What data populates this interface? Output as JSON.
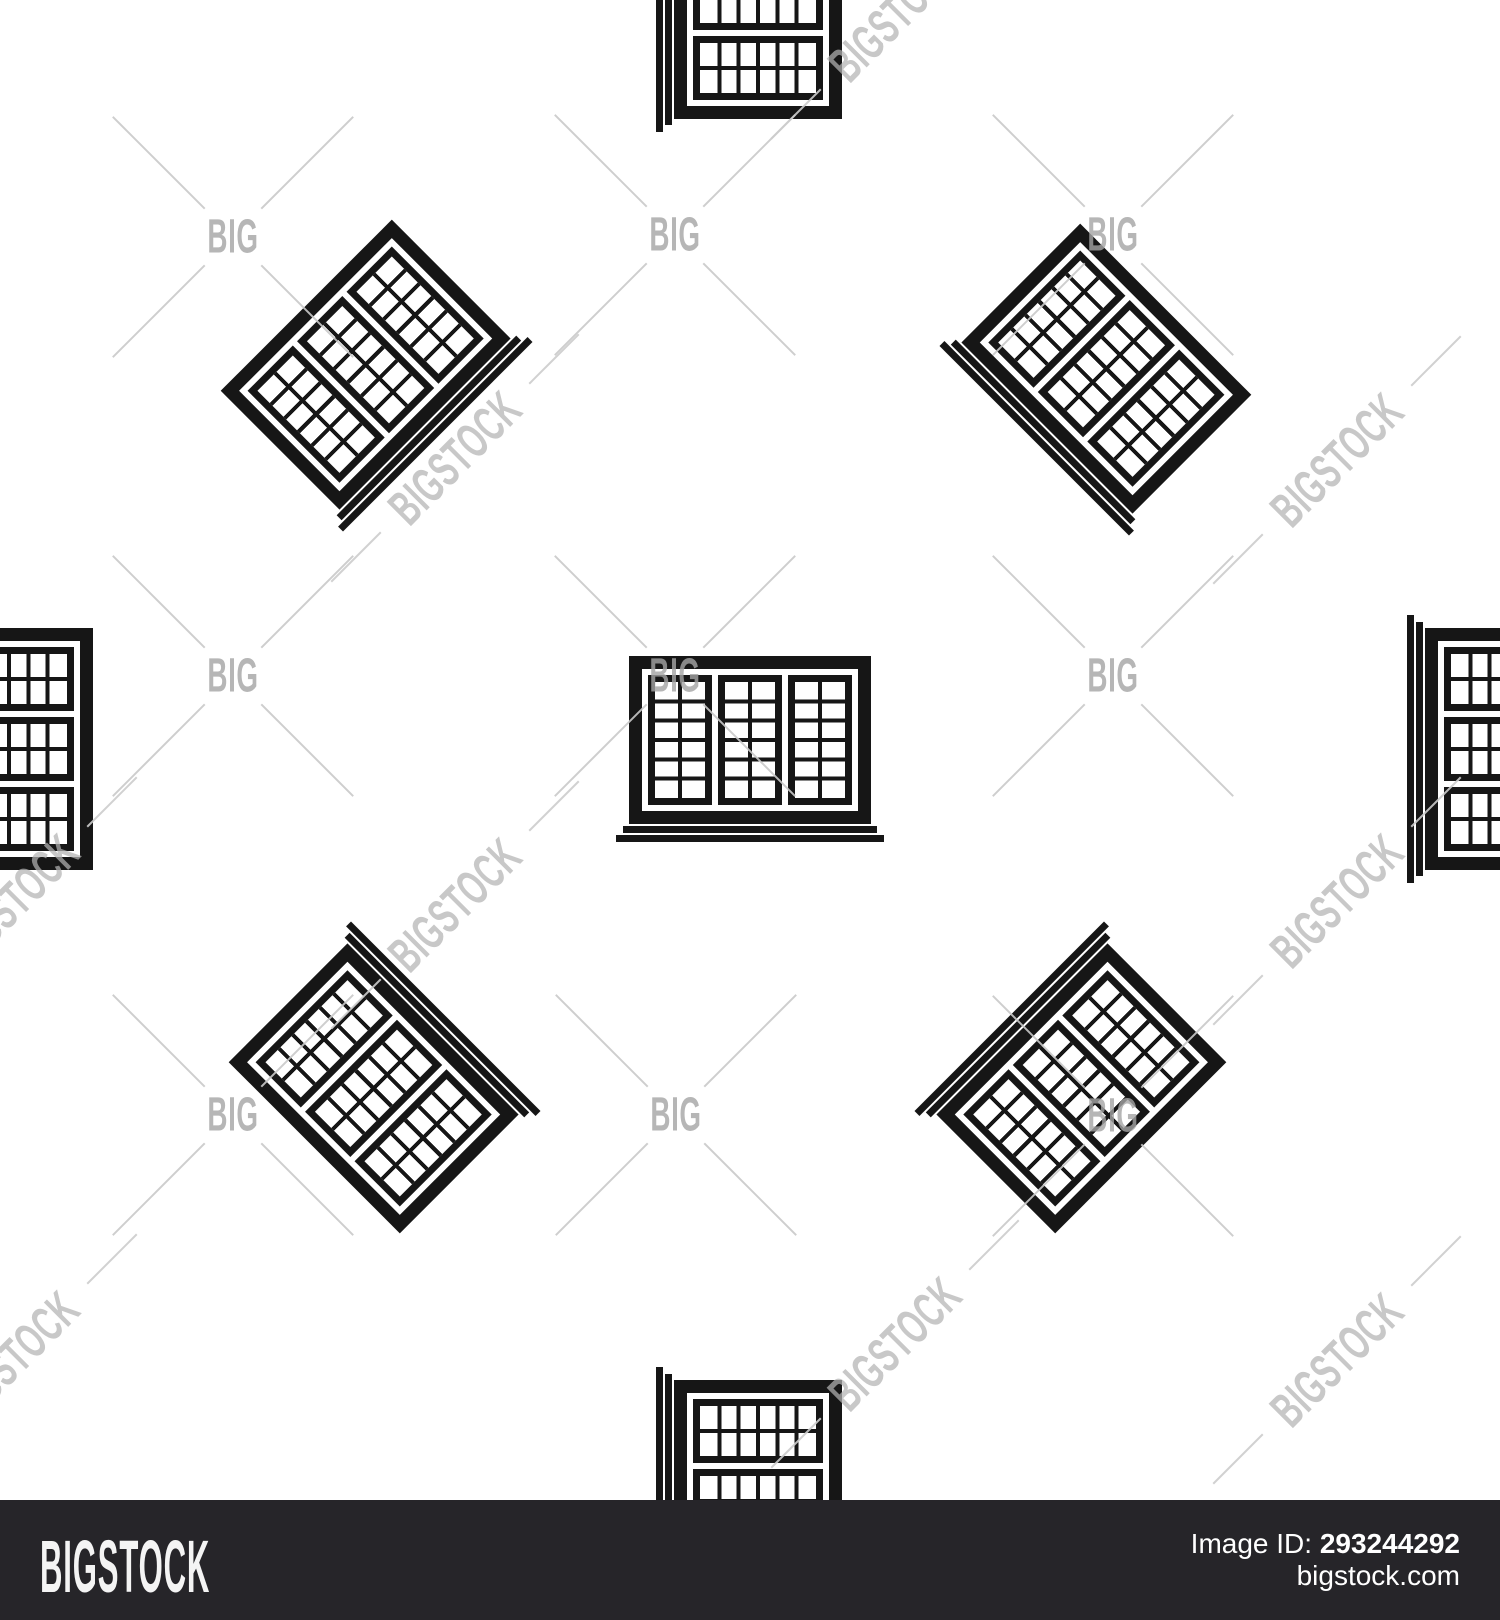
{
  "pattern": {
    "icon": "window-with-sill-icon",
    "icon_color": "#161616",
    "background_color": "#ffffff",
    "description": "seamless pattern of black window icons, straight and rotated 45/90/135 degrees"
  },
  "watermark": {
    "big": "BIG",
    "bigstock": "BIGSTOCK",
    "text_color": "#a5a5a5",
    "line_color": "#c9c9c9"
  },
  "footer": {
    "logo": "BIGSTOCK",
    "image_id_label": "Image ID:",
    "image_id_value": "293244292",
    "website": "bigstock.com",
    "bar_color": "#262529"
  }
}
